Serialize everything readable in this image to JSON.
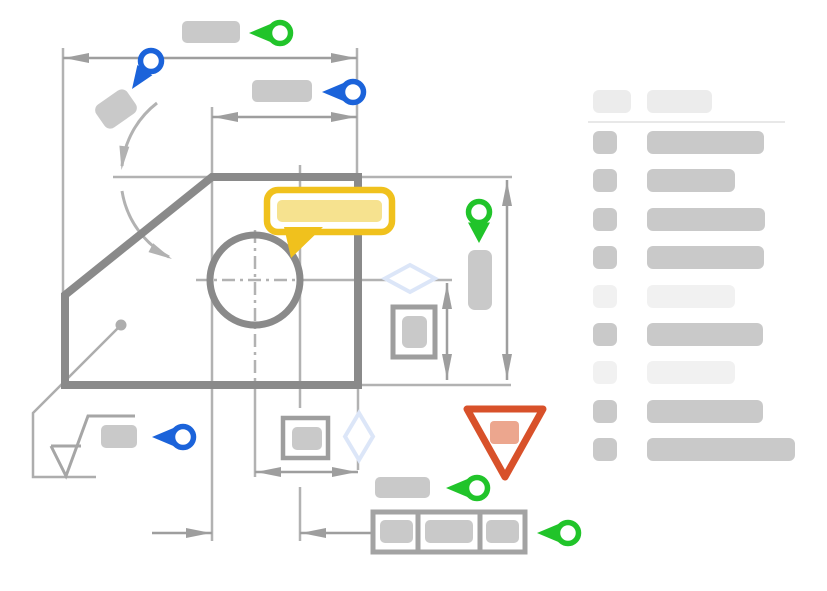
{
  "canvas": {
    "width": 827,
    "height": 591,
    "background": "#ffffff"
  },
  "colors": {
    "green": "#21c42a",
    "blue": "#1b63da",
    "yellow": "#f0c11d",
    "yellow_fill": "#f6e28f",
    "red": "#d8512a",
    "red_fill": "#eca68e",
    "shape": "#8a8a8a",
    "dim": "#9e9e9e",
    "thin": "#b2b2b2",
    "leader": "#adadad",
    "symbol": "#a6a6a6",
    "frame": "#a3a3a3",
    "placeholder": "#c9c9c9",
    "placeholder_light": "#f1f1f1",
    "header_chip": "#ececec",
    "divider": "#e8e8e8",
    "diamond": "#dce6f8",
    "bg": "#ffffff"
  },
  "drawing": {
    "part": {
      "type": "chamfered-plate-outline",
      "hole": "circle-with-centerlines"
    },
    "annotations": [
      {
        "name": "comment-bubble",
        "color_key": "yellow"
      },
      {
        "name": "warning-triangle",
        "color_key": "red"
      },
      {
        "name": "pin-green-left-top",
        "color_key": "green"
      },
      {
        "name": "pin-blue-rotated-top-left",
        "color_key": "blue"
      },
      {
        "name": "pin-blue-left-upper",
        "color_key": "blue"
      },
      {
        "name": "pin-green-down-right",
        "color_key": "green"
      },
      {
        "name": "pin-blue-left-bottom",
        "color_key": "blue"
      },
      {
        "name": "pin-green-left-bottom",
        "color_key": "green"
      },
      {
        "name": "pin-green-left-frame",
        "color_key": "green"
      }
    ],
    "symbols": [
      "angular-dimension-arc",
      "surface-finish-symbol",
      "boxed-tolerance-symbol-right",
      "boxed-tolerance-symbol-bottom",
      "diamond-marker-right",
      "diamond-marker-bottom",
      "feature-control-frame-3-cells"
    ],
    "dimensions": [
      "horizontal-overall-top",
      "horizontal-inner-top",
      "vertical-overall-right",
      "vertical-inner-right",
      "horizontal-inner-bottom",
      "horizontal-outer-bottom"
    ]
  },
  "sidebar": {
    "header": {
      "square_width": 38,
      "bar_width": 65
    },
    "rows": [
      {
        "tone": "dark",
        "bar_width": 117
      },
      {
        "tone": "dark",
        "bar_width": 88
      },
      {
        "tone": "dark",
        "bar_width": 118
      },
      {
        "tone": "dark",
        "bar_width": 117
      },
      {
        "tone": "light",
        "bar_width": 88
      },
      {
        "tone": "dark",
        "bar_width": 116
      },
      {
        "tone": "light",
        "bar_width": 88
      },
      {
        "tone": "dark",
        "bar_width": 116
      },
      {
        "tone": "dark",
        "bar_width": 148
      }
    ]
  }
}
